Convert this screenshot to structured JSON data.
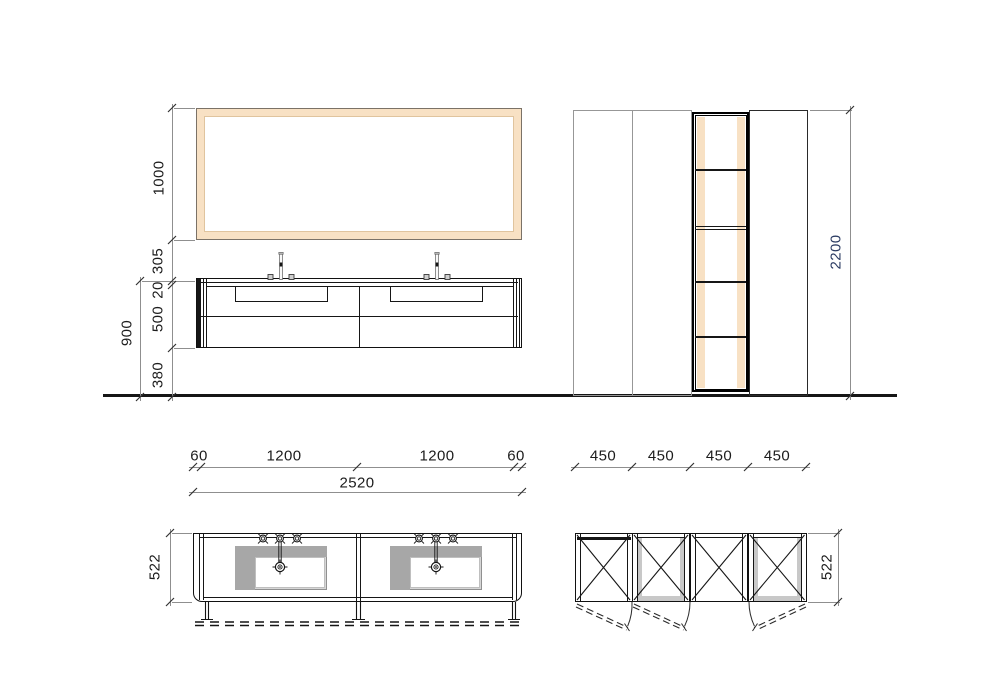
{
  "colors": {
    "accent_beige": "#f8e1c4",
    "frame_outline": "#7b7267",
    "basin_gray_light": "#d6d6d6",
    "basin_gray_dark": "#a7a7a7",
    "cabinet_gray_outline": "#979797",
    "dimension_line": "#8f8f8f",
    "dimension_text": "#1c1c1c",
    "dimension_text_blue": "#2c3c63"
  },
  "elevation": {
    "mirror_height": {
      "label": "1000"
    },
    "mirror_gap": {
      "label": "305"
    },
    "counter_thickness": {
      "label": "20"
    },
    "cabinet_height": {
      "label": "500"
    },
    "floor_clearance": {
      "label": "380"
    },
    "worktop_height": {
      "label": "900"
    },
    "column_height": {
      "label": "2200"
    }
  },
  "plan_vanity": {
    "offsets": [
      {
        "label": "60"
      },
      {
        "label": "1200"
      },
      {
        "label": "1200"
      },
      {
        "label": "60"
      }
    ],
    "total_width": {
      "label": "2520"
    },
    "depth": {
      "label": "522"
    }
  },
  "plan_columns": {
    "widths": [
      {
        "label": "450"
      },
      {
        "label": "450"
      },
      {
        "label": "450"
      },
      {
        "label": "450"
      }
    ],
    "depth": {
      "label": "522"
    }
  }
}
